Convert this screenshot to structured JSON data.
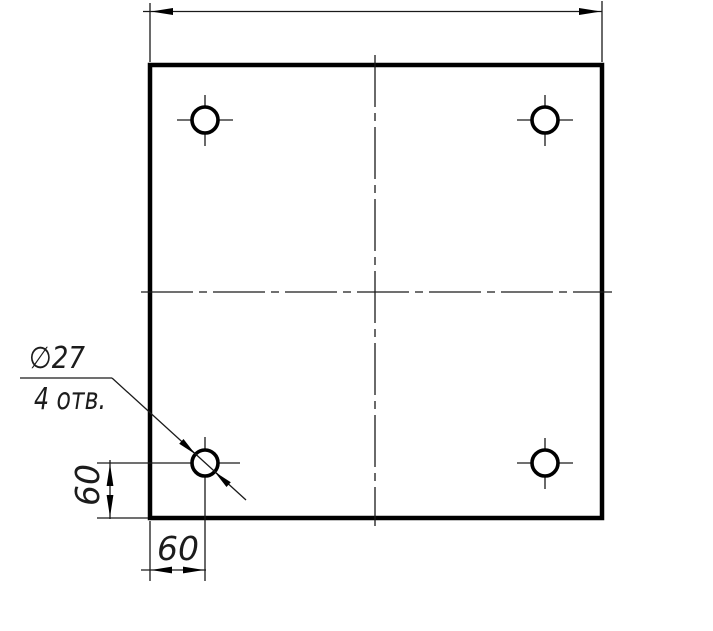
{
  "drawing": {
    "type": "engineering-drawing",
    "view": "square plate, front view, four through holes",
    "colors": {
      "line": "#000000",
      "background": "#ffffff"
    },
    "callout": {
      "line1": "∅27",
      "line2": "4 отв."
    },
    "dimensions": {
      "left_vertical_label": "60",
      "bottom_horizontal_label": "60",
      "top_overall_label": ""
    },
    "holes": {
      "count": 4,
      "diameter_label": "27",
      "offset_from_edges_label": "60"
    }
  }
}
